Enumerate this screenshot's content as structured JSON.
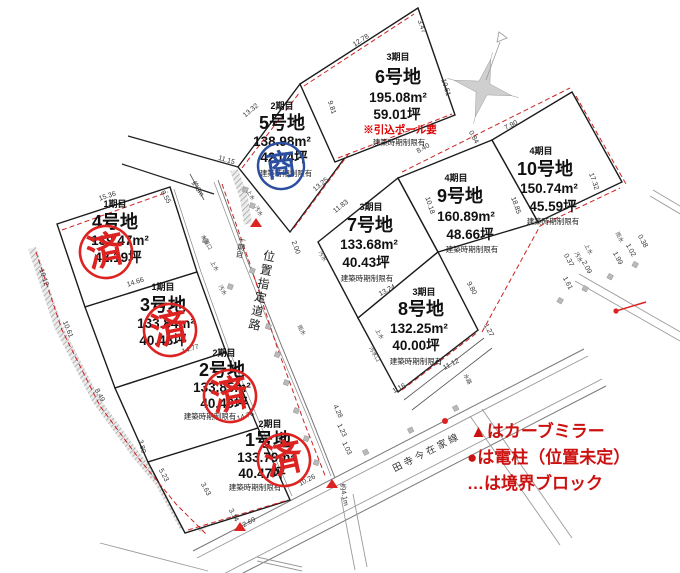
{
  "map": {
    "plots": [
      {
        "num": "1",
        "phase": "2期目",
        "name": "1号地",
        "area": "133.79m²",
        "tsubo": "40.47坪",
        "note": "建築時期制限有",
        "stamp": "済"
      },
      {
        "num": "2",
        "phase": "2期目",
        "name": "2号地",
        "area": "133.85m²",
        "tsubo": "40.49坪",
        "note": "建築時期制限有",
        "stamp": "済"
      },
      {
        "num": "3",
        "phase": "1期目",
        "name": "3号地",
        "area": "133.84m²",
        "tsubo": "40.48坪",
        "note": "",
        "stamp": "済"
      },
      {
        "num": "4",
        "phase": "1期目",
        "name": "4号地",
        "area": "139.47m²",
        "tsubo": "42.19坪",
        "note": "",
        "stamp": "済"
      },
      {
        "num": "5",
        "phase": "2期目",
        "name": "5号地",
        "area": "138.98m²",
        "tsubo": "42.04坪",
        "note": "建築時期制限有",
        "stamp": "商"
      },
      {
        "num": "6",
        "phase": "3期目",
        "name": "6号地",
        "area": "195.08m²",
        "tsubo": "59.01坪",
        "note": "建築時期制限有",
        "extra": "※引込ポール要"
      },
      {
        "num": "7",
        "phase": "3期目",
        "name": "7号地",
        "area": "133.68m²",
        "tsubo": "40.43坪",
        "note": "建築時期制限有"
      },
      {
        "num": "8",
        "phase": "3期目",
        "name": "8号地",
        "area": "132.25m²",
        "tsubo": "40.00坪",
        "note": "建築時期制限有"
      },
      {
        "num": "9",
        "phase": "4期目",
        "name": "9号地",
        "area": "160.89m²",
        "tsubo": "48.66坪",
        "note": "建築時期制限有"
      },
      {
        "num": "10",
        "phase": "4期目",
        "name": "10号地",
        "area": "150.74m²",
        "tsubo": "45.59坪",
        "note": "建築時期制限有"
      }
    ],
    "stamps": {
      "sold": "済",
      "pending": "商"
    },
    "roads": {
      "central": "位置指定道路",
      "central_sub": "一期目",
      "bottom": "田寺今在家線"
    },
    "legend": [
      "▲はカーブミラー",
      "●は電柱（位置未定）",
      "…は境界ブロック"
    ],
    "dims": [
      "15.36",
      "10.12",
      "10.61",
      "8.49",
      "3.80",
      "5.23",
      "3.63",
      "3.14",
      "2.69",
      "10.26",
      "14.66",
      "14.77",
      "14.76",
      "13.32",
      "9.81",
      "12.78",
      "3.47",
      "10.51",
      "0.84",
      "7.90",
      "17.32",
      "8.40",
      "11.83",
      "10.18",
      "13.25",
      "2.00",
      "11.15",
      "約6m",
      "8.55",
      "13.24",
      "9.80",
      "1.27",
      "11.12",
      "1.16",
      "18.85",
      "0.38",
      "1.02",
      "1.99",
      "2.09",
      "0.37",
      "1.61",
      "4.28",
      "1.23",
      "1.03",
      "約4.1m"
    ],
    "utilities": [
      "水道口",
      "上水",
      "汚水",
      "上水",
      "汚水",
      "汚水",
      "雨水",
      "上水",
      "汚水口",
      "水路",
      "雨水",
      "上水",
      "汚水"
    ]
  }
}
